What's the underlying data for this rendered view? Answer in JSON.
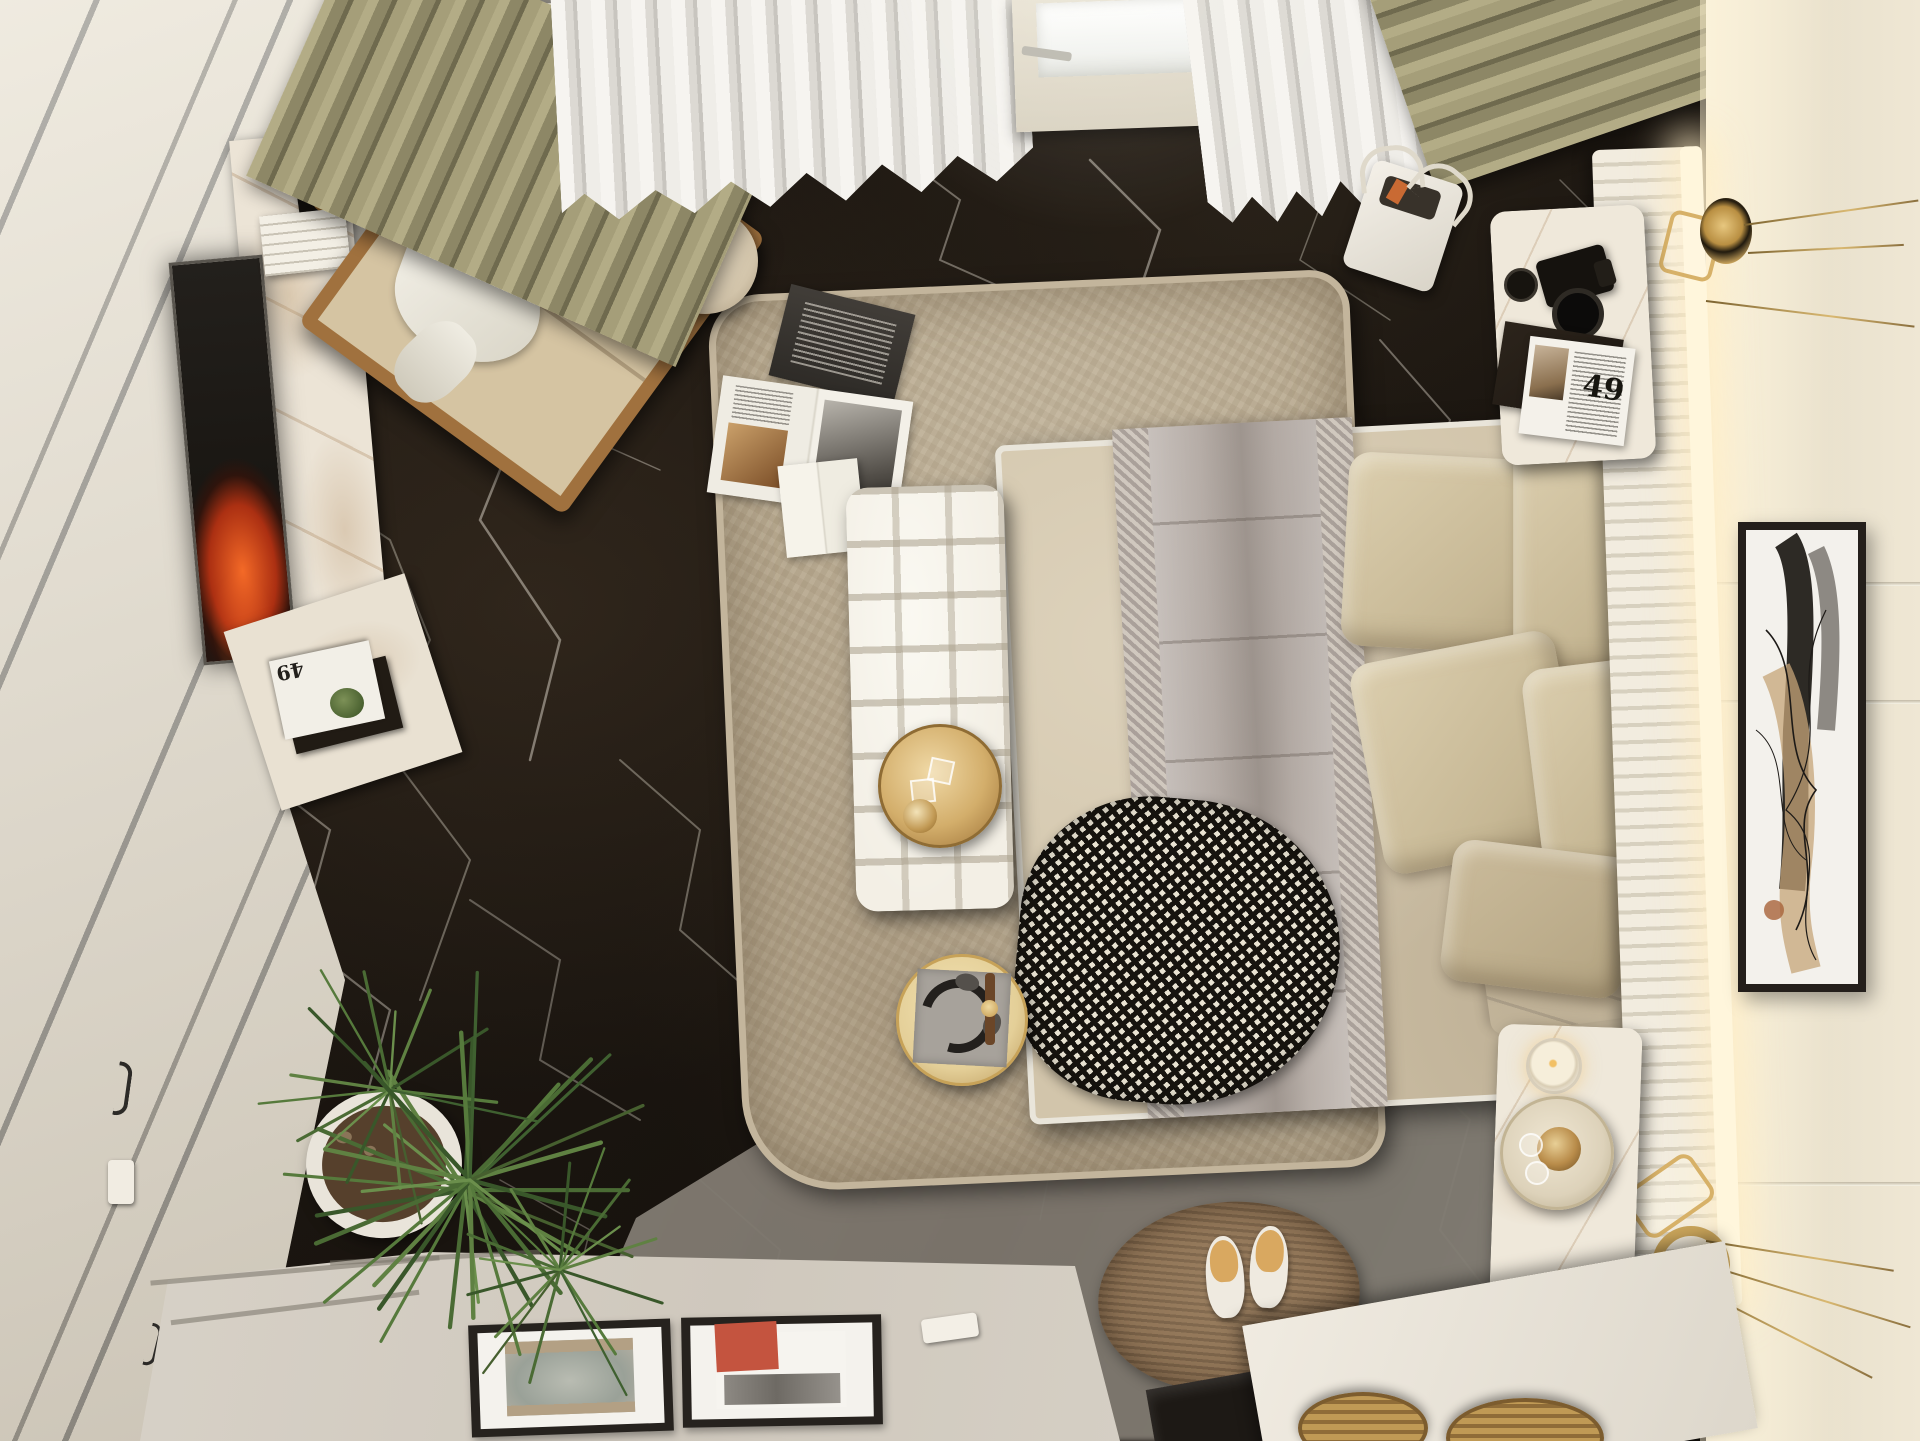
{
  "scene": {
    "title": "Top-down 3D render of a modern luxury bedroom",
    "view": "bird's-eye / plan view, photorealistic interior visualization",
    "magazine_number": "49",
    "objects": [
      {
        "name": "black-marble-floor",
        "note": "dark brown-black marble with white veining"
      },
      {
        "name": "gray-marble-floor",
        "note": "lighter warm-gray marble zone at bottom right"
      },
      {
        "name": "wardrobe",
        "note": "cream cabinetry with diagonal gray reveal lines, left wall"
      },
      {
        "name": "fireplace-screen",
        "note": "dark vertical panel with orange flames beside white marble column"
      },
      {
        "name": "marble-column",
        "note": "white marble TV wall column with book stack and shell on black plate"
      },
      {
        "name": "armchair",
        "note": "beige lounge chair with wood frame and white throw cloth"
      },
      {
        "name": "side-table",
        "note": "round beige side table with glass sphere lamp"
      },
      {
        "name": "olive-curtains",
        "note": "pleated olive-green drapes at window wall"
      },
      {
        "name": "sheer-curtains",
        "note": "white sheer pleated curtains"
      },
      {
        "name": "balcony-door",
        "note": "white door with bright glass and metal handle"
      },
      {
        "name": "area-rug",
        "note": "large beige shaggy rectangular rug"
      },
      {
        "name": "books-on-rug",
        "note": "dark closed book, open magazine, open white book"
      },
      {
        "name": "bed",
        "note": "double bed with beige duvet, white piping"
      },
      {
        "name": "gray-blanket",
        "note": "greige quilted runner with herringbone borders"
      },
      {
        "name": "houndstooth-throw",
        "note": "black and white houndstooth throw at foot of bed"
      },
      {
        "name": "pillows",
        "note": "five beige linen pillows near headboard"
      },
      {
        "name": "tufted-bench",
        "note": "white quilted bench at foot of bed with round gold tray"
      },
      {
        "name": "gold-tray",
        "note": "brass tray with glasses and bowl"
      },
      {
        "name": "coffee-table",
        "note": "small round gold table with gray mat, headphones and watch"
      },
      {
        "name": "headboard",
        "note": "white ribbed slat headboard panel with warm LED strip"
      },
      {
        "name": "upholstered-wall",
        "note": "cream padded wall with horizontal grooves"
      },
      {
        "name": "wall-art",
        "note": "tall black-framed abstract artwork on right wall"
      },
      {
        "name": "wall-lamps",
        "note": "two brass disc sconces with long thin rods"
      },
      {
        "name": "nightstand-top",
        "note": "white marble nightstand with DSLR camera, lens cap, folder, magazine 49"
      },
      {
        "name": "nightstand-bottom",
        "note": "white marble nightstand with candle and drinks tray"
      },
      {
        "name": "tote-bag",
        "note": "white shopper bag on floor near window"
      },
      {
        "name": "jute-rug",
        "note": "oval brown jute rug with white slippers"
      },
      {
        "name": "slippers",
        "note": "pair of white slippers with tan insoles"
      },
      {
        "name": "dresser",
        "note": "low cream console at bottom with two framed artworks lying flat"
      },
      {
        "name": "framed-art-gray",
        "note": "abstract gray/taupe print in black frame"
      },
      {
        "name": "framed-art-red",
        "note": "abstract print with red square in black frame"
      },
      {
        "name": "plant",
        "note": "spiky dracaena plant in white round pot"
      },
      {
        "name": "baskets",
        "note": "wicker baskets under vanity at bottom right"
      },
      {
        "name": "vanity",
        "note": "white-topped unit with dark glass front"
      }
    ],
    "palette": {
      "floor_marble_dark": "#1b1611",
      "floor_marble_gray": "#8b857c",
      "marble_vein": "#e8e1d4",
      "cabinet_cream": "#e7e0d2",
      "rug_beige": "#b5a78e",
      "bed_duvet": "#d2c5ab",
      "blanket_gray": "#b5aca6",
      "bench_white": "#f3efe5",
      "gold_accent": "#d3ae6b",
      "olive_curtain": "#a9a27c",
      "sheer_white": "#efede8",
      "wall_cream": "#efe7d4",
      "wood": "#a0713e",
      "plant_green": "#4a6b34",
      "fire_orange": "#ff6e28",
      "art_red": "#c4543f",
      "jute_brown": "#8c7154"
    }
  }
}
